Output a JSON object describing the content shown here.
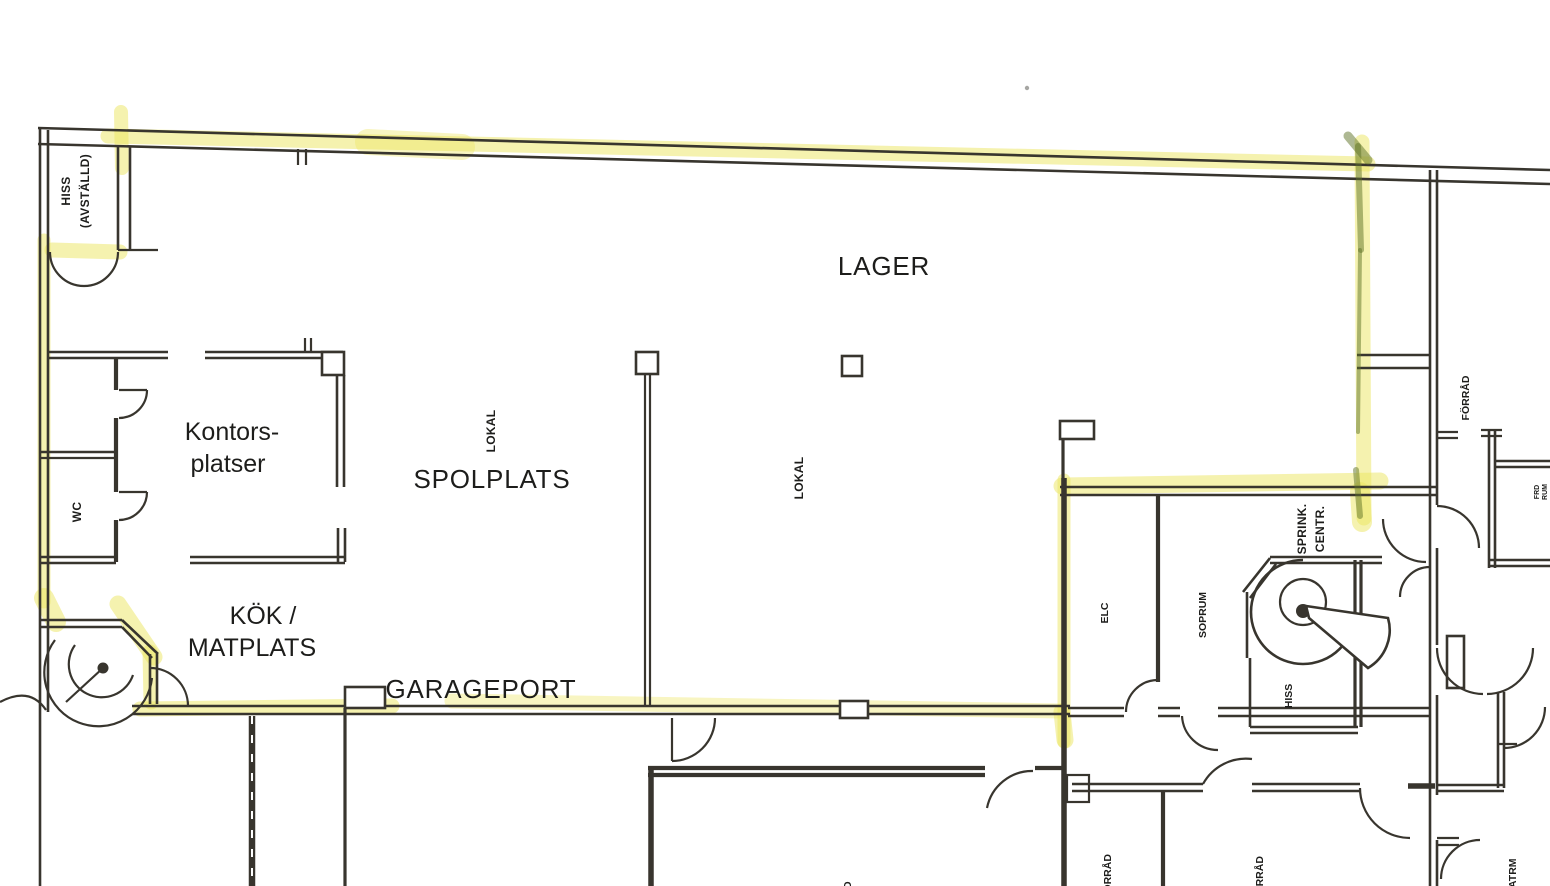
{
  "plan": {
    "rooms": {
      "lager": "LAGER",
      "spolplats": "SPOLPLATS",
      "garageport": "GARAGEPORT",
      "kontors_line1": "Kontors-",
      "kontors_line2": "platser",
      "kok_line1": "KÖK /",
      "kok_line2": "MATPLATS",
      "hiss_shaft_line1": "HISS",
      "hiss_shaft_line2": "(AVSTÄLLD)",
      "wc": "WC",
      "lokal_a": "LOKAL",
      "lokal_b": "LOKAL",
      "sprink_line1": "SPRINK.",
      "sprink_line2": "CENTR.",
      "elc": "ELC",
      "soprum": "SOPRUM",
      "hiss_small": "HISS",
      "forrad_right": "FÖRRÅD",
      "forrad_bottom_left": "FÖRRÅD",
      "forrad_bottom_mid": "FÖRRÅD",
      "partial_bottom_center": "D",
      "partial_bottom_right": "ATRM",
      "edge_small_line1": "FRD",
      "edge_small_line2": "RUM"
    }
  },
  "colors": {
    "paper": "#ffffff",
    "ink": "#38352e",
    "highlight": "#ece55f",
    "marker_green": "#5d7226"
  }
}
